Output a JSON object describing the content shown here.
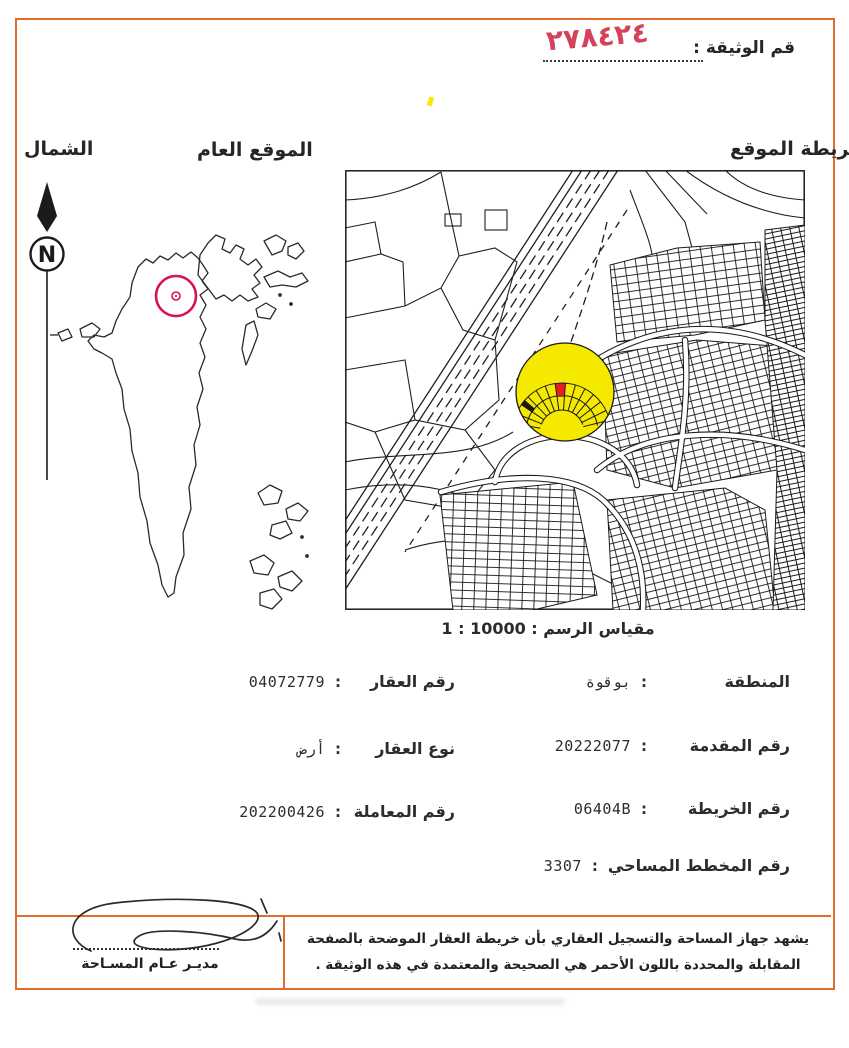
{
  "document": {
    "doc_number_label": "قم الوثيقة :",
    "doc_number_value": "٢٧٨٤٢٤"
  },
  "headers": {
    "north": "الشمال",
    "general_location": "الموقع العام",
    "site_map": "خريطة الموقع"
  },
  "compass": {
    "letter": "N"
  },
  "map": {
    "scale_label": "مقياس الرسم : 10000 : 1"
  },
  "fields": {
    "separator": ":",
    "right": [
      {
        "label": "المنطقة",
        "value": "بوقوة"
      },
      {
        "label": "رقم المقدمة",
        "value": "20222077"
      },
      {
        "label": "رقم الخريطة",
        "value": "06404B"
      },
      {
        "label": "رقم المخطط المساحي",
        "value": "3307"
      }
    ],
    "left": [
      {
        "label": "رقم العقار",
        "value": "04072779"
      },
      {
        "label": "نوع العقار",
        "value": "أرض"
      },
      {
        "label": "رقم المعاملة",
        "value": "202200426"
      }
    ]
  },
  "footer": {
    "certification_line1": "يشهد جهاز المساحة والتسجيل العقاري بأن خريطة العقار الموضحة بالصفحة",
    "certification_line2": "المقابلة والمحددة باللون الأحمر هي الصحيحة والمعتمدة في هذه الوثيقة .",
    "signature_title": "مديـر عـام المسـاحة"
  },
  "colors": {
    "border_orange": "#e26b2e",
    "highlight_yellow": "#f5e900",
    "marker_red": "#d6134e",
    "parcel_red": "#e31e24",
    "handwriting_red": "#d4425c"
  }
}
